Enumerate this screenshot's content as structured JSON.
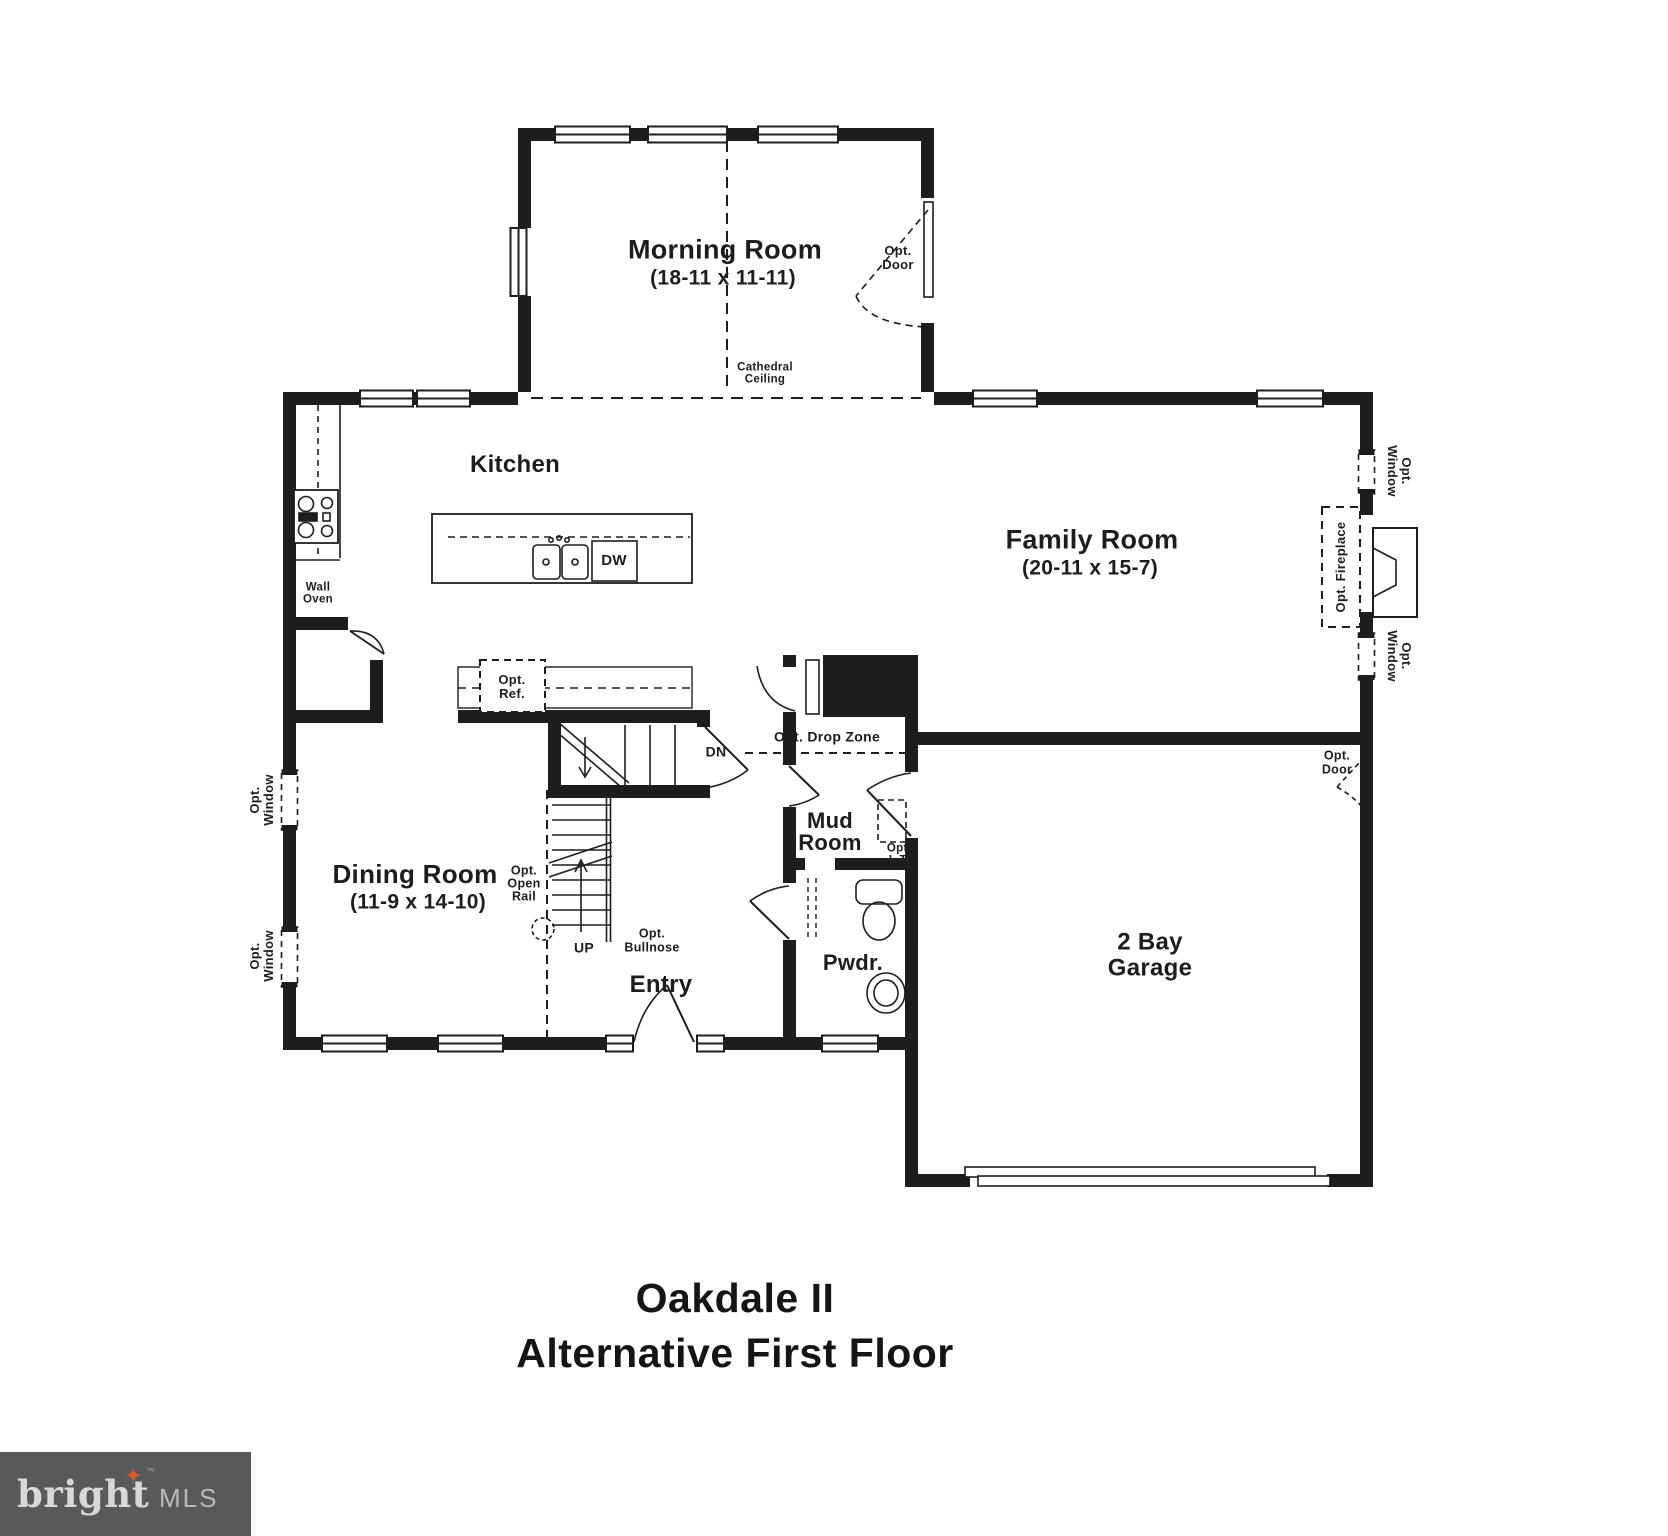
{
  "title": {
    "line1": "Oakdale II",
    "line2": "Alternative First Floor"
  },
  "brand": {
    "wordmark": "bright",
    "suffix": "MLS",
    "tm": "™",
    "star_icon": "four-point-star"
  },
  "rooms": {
    "morning": {
      "name": "Morning Room",
      "dims": "(18-11 x 11-11)"
    },
    "kitchen": {
      "name": "Kitchen"
    },
    "family": {
      "name": "Family Room",
      "dims": "(20-11 x 15-7)"
    },
    "dining": {
      "name": "Dining Room",
      "dims": "(11-9 x 14-10)"
    },
    "entry": {
      "name": "Entry"
    },
    "mud_room": {
      "name": "Mud Room"
    },
    "powder": {
      "name": "Pwdr."
    },
    "garage": {
      "name": "2 Bay Garage"
    }
  },
  "annotations": {
    "cathedral_ceiling": "Cathedral Ceiling",
    "opt_door": "Opt. Door",
    "opt_window": "Opt. Window",
    "opt_fireplace": "Opt. Fireplace",
    "wall_oven": "Wall Oven",
    "dishwasher": "DW",
    "opt_ref": "Opt. Ref.",
    "down": "DN",
    "up": "UP",
    "opt_drop_zone": "Opt. Drop Zone",
    "opt_lt": "Opt. L.T.",
    "opt_open_rail": "Opt. Open Rail",
    "opt_bullnose": "Opt. Bullnose"
  },
  "colors": {
    "ink": "#1d1d1b",
    "brand_bg": "#58595b",
    "brand_star": "#d95b2e",
    "brand_text": "#d8d8d6"
  }
}
